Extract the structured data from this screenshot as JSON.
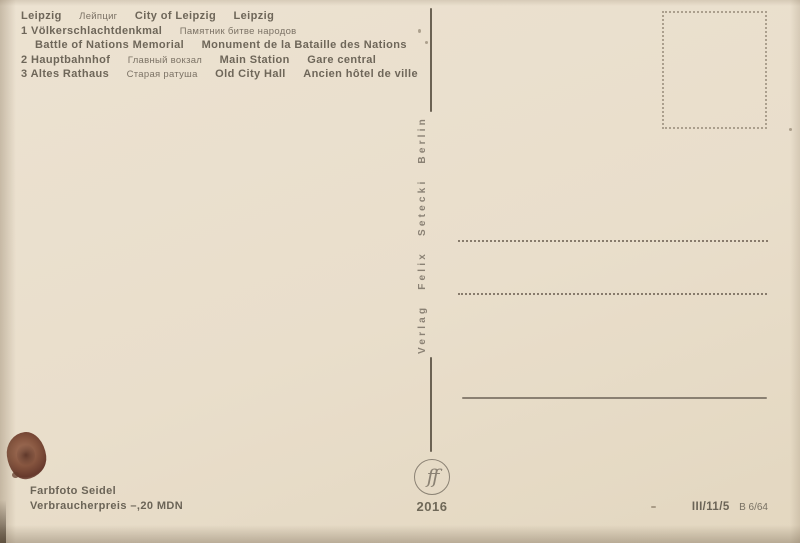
{
  "postcard": {
    "caption": {
      "lines": [
        [
          "Leipzig",
          "Лейпциг",
          "City of Leipzig",
          "Leipzig"
        ],
        [
          "1 Völkerschlachtdenkmal",
          "Памятник битве народов"
        ],
        [
          "Battle of Nations Memorial",
          "Monument de la Bataille des Nations"
        ],
        [
          "2 Hauptbahnhof",
          "Главный вокзал",
          "Main Station",
          "Gare central"
        ],
        [
          "3 Altes Rathaus",
          "Старая ратуша",
          "Old City Hall",
          "Ancien hôtel de ville"
        ]
      ]
    },
    "spine": {
      "publisher": "Verlag Felix Setecki Berlin"
    },
    "logo": {
      "monogram": "ff",
      "order_number": "2016"
    },
    "footer": {
      "photo_credit": "Farbfoto Seidel",
      "price": "Verbraucherpreis –,20 MDN",
      "print_code": "III/11/5",
      "print_code_sub": "B 6/64"
    },
    "colors": {
      "card_background": "#e9decb",
      "ink": "#6b6356",
      "ruled_line": "#8a8072",
      "stamp_box_border": "#ab9f8d",
      "stain": "#6e4434"
    }
  }
}
